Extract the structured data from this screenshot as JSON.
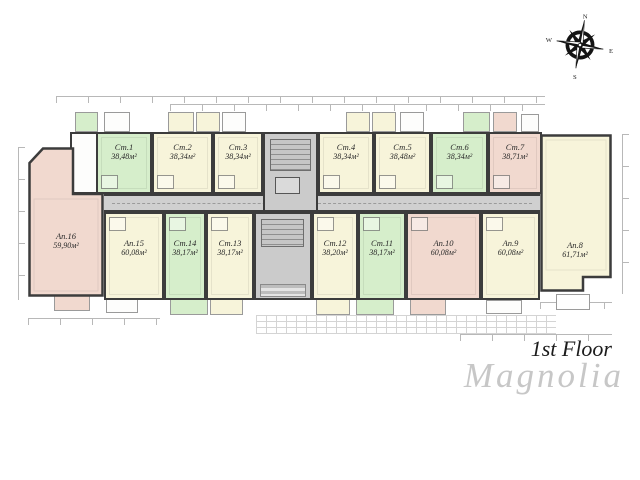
{
  "header": {
    "floor_label": "1st Floor",
    "project_name": "Magnolia"
  },
  "compass": {
    "north": "N",
    "east": "E",
    "south": "S",
    "west": "W"
  },
  "colors": {
    "unit_green": "#d6eecb",
    "unit_cream": "#f7f4da",
    "unit_pink": "#f1d9cf",
    "corridor_gray": "#d0d0d0",
    "wall": "#3c3c3c"
  },
  "units": [
    {
      "id": "st1",
      "label": "Ст.1",
      "area": "38,48м²",
      "color": "green"
    },
    {
      "id": "st2",
      "label": "Ст.2",
      "area": "38,34м²",
      "color": "cream"
    },
    {
      "id": "st3",
      "label": "Ст.3",
      "area": "38,34м²",
      "color": "cream"
    },
    {
      "id": "st4",
      "label": "Ст.4",
      "area": "38,34м²",
      "color": "cream"
    },
    {
      "id": "st5",
      "label": "Ст.5",
      "area": "38,48м²",
      "color": "cream"
    },
    {
      "id": "st6",
      "label": "Ст.6",
      "area": "38,34м²",
      "color": "green"
    },
    {
      "id": "st7",
      "label": "Ст.7",
      "area": "38,71м²",
      "color": "pink"
    },
    {
      "id": "ap8",
      "label": "Ап.8",
      "area": "61,71м²",
      "color": "cream"
    },
    {
      "id": "ap9",
      "label": "Ап.9",
      "area": "60,08м²",
      "color": "cream"
    },
    {
      "id": "ap10",
      "label": "Ап.10",
      "area": "60,08м²",
      "color": "pink"
    },
    {
      "id": "st11",
      "label": "Ст.11",
      "area": "38,17м²",
      "color": "green"
    },
    {
      "id": "st12",
      "label": "Ст.12",
      "area": "38,20м²",
      "color": "cream"
    },
    {
      "id": "st13",
      "label": "Ст.13",
      "area": "38,17м²",
      "color": "cream"
    },
    {
      "id": "st14",
      "label": "Ст.14",
      "area": "38,17м²",
      "color": "green"
    },
    {
      "id": "ap15",
      "label": "Ап.15",
      "area": "60,08м²",
      "color": "cream"
    },
    {
      "id": "ap16",
      "label": "Ап.16",
      "area": "59,90м²",
      "color": "pink"
    }
  ]
}
